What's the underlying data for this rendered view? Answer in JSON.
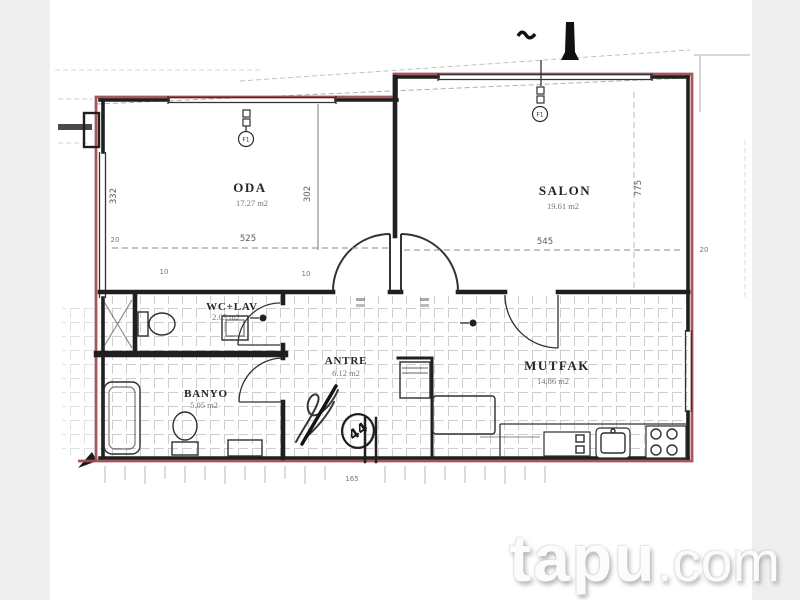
{
  "watermark": {
    "brand": "tapu",
    "suffix": ".com"
  },
  "rooms": {
    "oda": {
      "label": "ODA",
      "area": "17.27 m2"
    },
    "salon": {
      "label": "SALON",
      "area": "19.61 m2"
    },
    "wc_lav": {
      "label": "WC+LAV",
      "area": "2.05 m2"
    },
    "banyo": {
      "label": "BANYO",
      "area": "5.05 m2"
    },
    "antre": {
      "label": "ANTRE",
      "area": "6.12 m2"
    },
    "mutfak": {
      "label": "MUTFAK",
      "area": "14.86 m2"
    }
  },
  "dimensions": {
    "oda_width": "525",
    "salon_width": "545",
    "oda_height_left": "332",
    "oda_height_right": "302",
    "salon_height_right": "775",
    "wall_left_top": "20",
    "wall_left_mid": "10",
    "wall_mid": "10",
    "wall_right": "20",
    "entry_span": "165"
  },
  "annotations": {
    "unit_number": "44",
    "window_tag_oda": "F1",
    "window_tag_salon": "F1"
  },
  "colors": {
    "ink": "#1f1f1f",
    "outline": "#a24e53",
    "hatch": "#c9c9c9",
    "panel": "#efefef"
  }
}
